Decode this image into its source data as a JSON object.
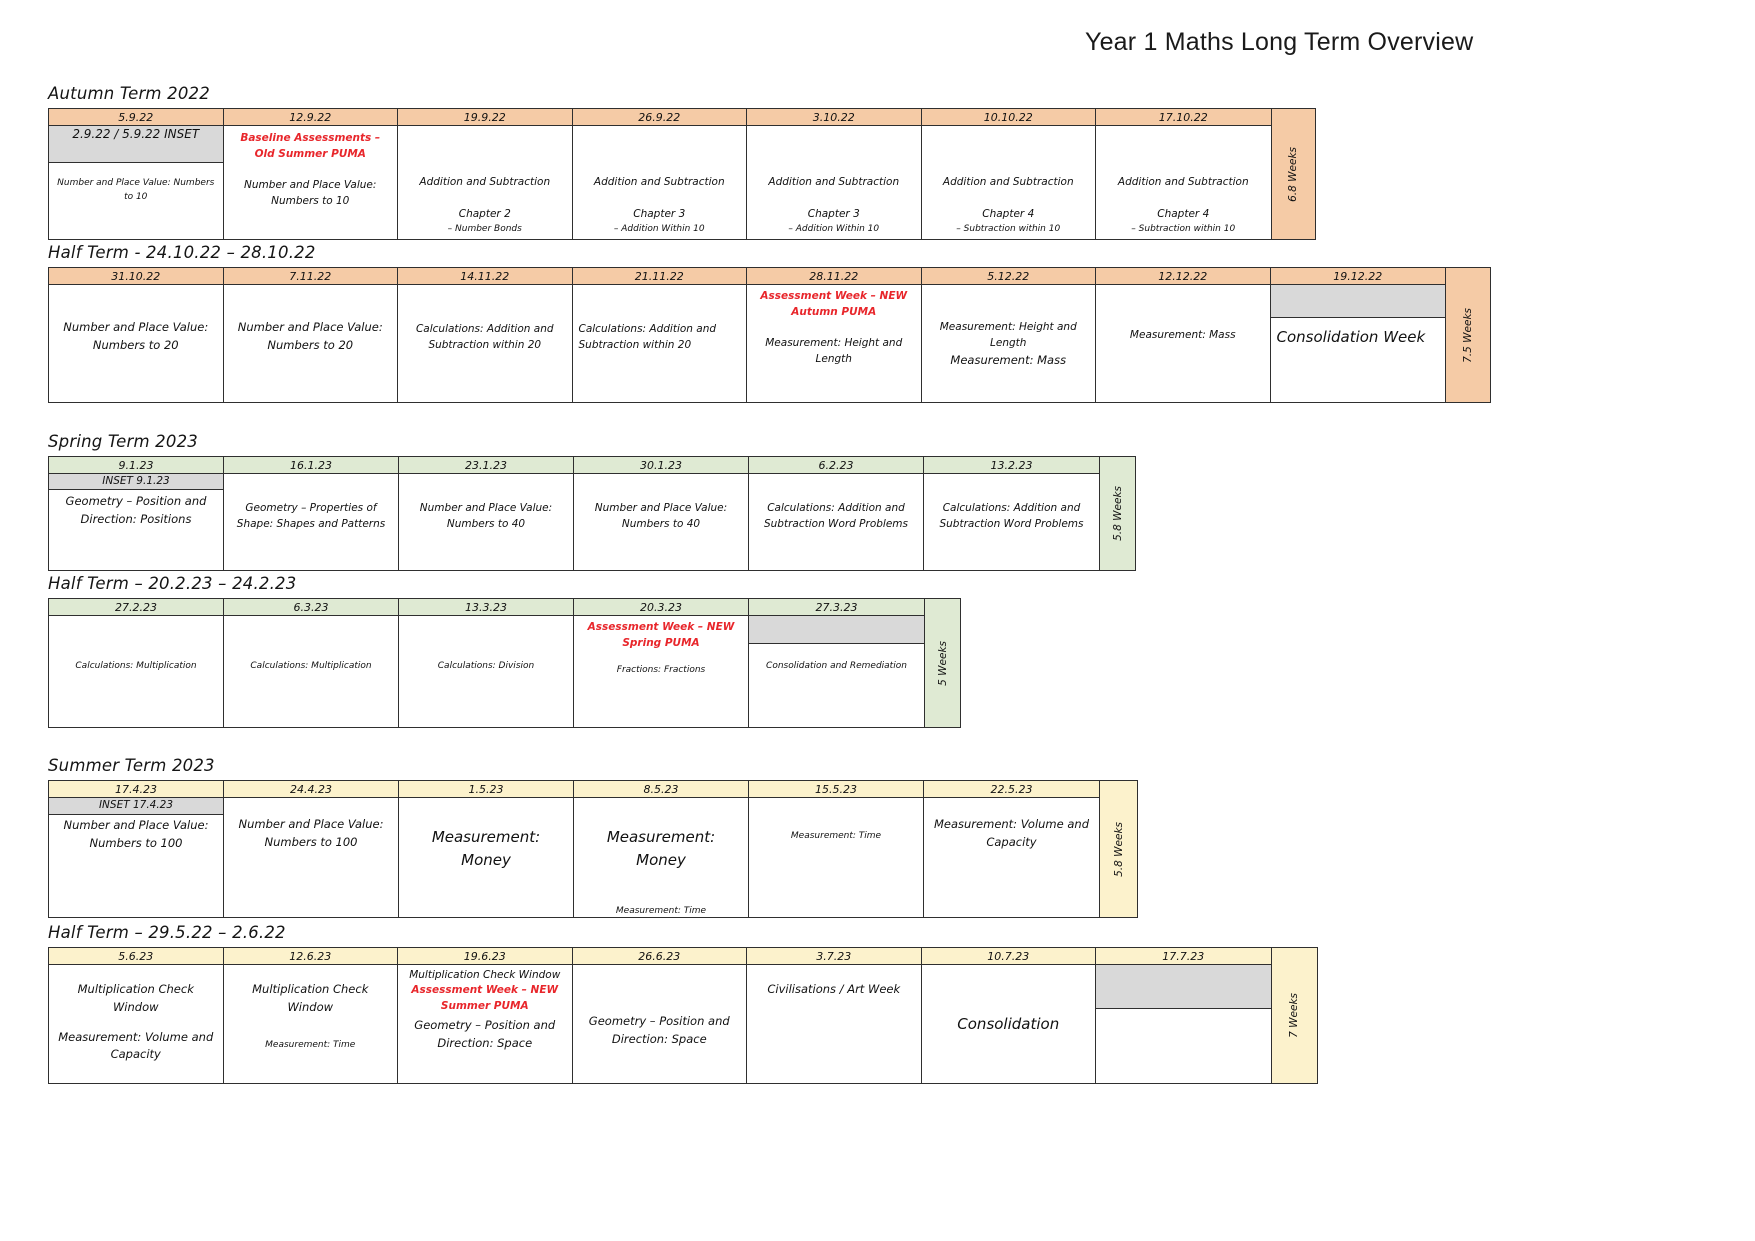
{
  "title": "Year 1 Maths Long Term Overview",
  "colors": {
    "autumn_header": "#F5CBA6",
    "spring_header": "#DFEAD3",
    "summer_header": "#FCF2CC",
    "inset_grey": "#D9D9D9",
    "assessment_red": "#E8262B",
    "border": "#2F2F2F"
  },
  "sections": [
    {
      "heading": "Autumn Term 2022",
      "theme": "autumn",
      "weeks": "6.8 Weeks",
      "layout": {
        "margin_top": 0,
        "col_width": 174.5,
        "body_height": 113,
        "weeks_width": 44
      },
      "cols": [
        {
          "date": "5.9.22",
          "blocks": [
            {
              "style": "inset",
              "text": "2.9.22 / 5.9.22 INSET",
              "h": 37,
              "fs": 12
            },
            {
              "style": "xs",
              "text": "Number and Place Value: Numbers to 10",
              "mt": 14
            }
          ]
        },
        {
          "date": "12.9.22",
          "blocks": [
            {
              "style": "red",
              "text": "Baseline Assessments – Old Summer PUMA",
              "mt": 5
            },
            {
              "style": "sm",
              "text": "Number and Place Value: Numbers to 10",
              "mt": 14
            }
          ]
        },
        {
          "date": "19.9.22",
          "blocks": [
            {
              "style": "sm",
              "text": "Addition and Subtraction",
              "mt": 48
            },
            {
              "style": "sm",
              "text": "Chapter 2",
              "mt": 16
            },
            {
              "style": "xs",
              "text": "– Number Bonds",
              "mt": 0
            }
          ]
        },
        {
          "date": "26.9.22",
          "blocks": [
            {
              "style": "sm",
              "text": "Addition and Subtraction",
              "mt": 48
            },
            {
              "style": "sm",
              "text": "Chapter 3",
              "mt": 16
            },
            {
              "style": "xs",
              "text": "– Addition Within 10",
              "mt": 0
            }
          ]
        },
        {
          "date": "3.10.22",
          "blocks": [
            {
              "style": "sm",
              "text": "Addition and Subtraction",
              "mt": 48
            },
            {
              "style": "sm",
              "text": "Chapter 3",
              "mt": 16
            },
            {
              "style": "xs",
              "text": "– Addition Within 10",
              "mt": 0
            }
          ]
        },
        {
          "date": "10.10.22",
          "blocks": [
            {
              "style": "sm",
              "text": "Addition and Subtraction",
              "mt": 48
            },
            {
              "style": "sm",
              "text": "Chapter 4",
              "mt": 16
            },
            {
              "style": "xs",
              "text": "– Subtraction within 10",
              "mt": 0
            }
          ]
        },
        {
          "date": "17.10.22",
          "blocks": [
            {
              "style": "sm",
              "text": "Addition and Subtraction",
              "mt": 48
            },
            {
              "style": "sm",
              "text": "Chapter 4",
              "mt": 16
            },
            {
              "style": "xs",
              "text": "– Subtraction within 10",
              "mt": 0
            }
          ]
        }
      ]
    },
    {
      "heading": "Half Term  - 24.10.22 – 28.10.22",
      "theme": "autumn",
      "weeks": "7.5 Weeks",
      "layout": {
        "margin_top": 3,
        "col_width": 174.5,
        "body_height": 117,
        "weeks_width": 45
      },
      "cols": [
        {
          "date": "31.10.22",
          "blocks": [
            {
              "style": "md",
              "text": "Number and Place Value: Numbers to 20",
              "mt": 34
            }
          ]
        },
        {
          "date": "7.11.22",
          "blocks": [
            {
              "style": "md",
              "text": "Number and Place Value: Numbers to 20",
              "mt": 34
            }
          ]
        },
        {
          "date": "14.11.22",
          "blocks": [
            {
              "style": "sm",
              "text": "Calculations: Addition and Subtraction within 20",
              "mt": 36
            }
          ]
        },
        {
          "date": "21.11.22",
          "blocks": [
            {
              "style": "sm",
              "text": "Calculations: Addition and Subtraction within 20",
              "mt": 36,
              "align": "left"
            }
          ]
        },
        {
          "date": "28.11.22",
          "blocks": [
            {
              "style": "red",
              "text": "Assessment Week – NEW Autumn PUMA",
              "mt": 4
            },
            {
              "style": "sm",
              "text": "Measurement: Height and Length",
              "mt": 14
            }
          ]
        },
        {
          "date": "5.12.22",
          "blocks": [
            {
              "style": "sm",
              "text": "Measurement: Height and Length",
              "mt": 34
            },
            {
              "style": "md",
              "text": "Measurement: Mass",
              "mt": 0
            }
          ]
        },
        {
          "date": "12.12.22",
          "blocks": [
            {
              "style": "sm",
              "text": "Measurement: Mass",
              "mt": 42
            }
          ]
        },
        {
          "date": "19.12.22",
          "blocks": [
            {
              "style": "grey",
              "h": 33
            },
            {
              "style": "lg",
              "text": "Consolidation Week",
              "mt": 8,
              "align": "left"
            }
          ]
        }
      ]
    },
    {
      "heading": "Spring Term 2023",
      "theme": "spring",
      "weeks": "5.8 Weeks",
      "layout": {
        "margin_top": 29,
        "col_width": 175,
        "body_height": 96,
        "weeks_width": 36
      },
      "cols": [
        {
          "date": "9.1.23",
          "blocks": [
            {
              "style": "inset",
              "text": "INSET 9.1.23",
              "h": 16
            },
            {
              "style": "md",
              "text": "Geometry – Position and Direction: Positions",
              "mt": 3
            }
          ]
        },
        {
          "date": "16.1.23",
          "blocks": [
            {
              "style": "sm",
              "text": "Geometry – Properties of Shape: Shapes and Patterns",
              "mt": 26
            }
          ]
        },
        {
          "date": "23.1.23",
          "blocks": [
            {
              "style": "sm",
              "text": "Number and Place Value: Numbers to 40",
              "mt": 26
            }
          ]
        },
        {
          "date": "30.1.23",
          "blocks": [
            {
              "style": "sm",
              "text": "Number and Place Value: Numbers to 40",
              "mt": 26
            }
          ]
        },
        {
          "date": "6.2.23",
          "blocks": [
            {
              "style": "sm",
              "text": "Calculations: Addition and Subtraction Word Problems",
              "mt": 26
            }
          ]
        },
        {
          "date": "13.2.23",
          "blocks": [
            {
              "style": "sm",
              "text": "Calculations: Addition and Subtraction Word Problems",
              "mt": 26
            }
          ]
        }
      ]
    },
    {
      "heading": "Half Term – 20.2.23 – 24.2.23",
      "theme": "spring",
      "weeks": "5 Weeks",
      "layout": {
        "margin_top": 3,
        "col_width": 175,
        "body_height": 111,
        "weeks_width": 36
      },
      "cols": [
        {
          "date": "27.2.23",
          "blocks": [
            {
              "style": "xs",
              "text": "Calculations: Multiplication",
              "mt": 44
            }
          ]
        },
        {
          "date": "6.3.23",
          "blocks": [
            {
              "style": "xs",
              "text": "Calculations: Multiplication",
              "mt": 44
            }
          ]
        },
        {
          "date": "13.3.23",
          "blocks": [
            {
              "style": "xs",
              "text": "Calculations: Division",
              "mt": 44
            }
          ]
        },
        {
          "date": "20.3.23",
          "blocks": [
            {
              "style": "red",
              "text": "Assessment Week – NEW Spring PUMA",
              "mt": 4
            },
            {
              "style": "xs",
              "text": "Fractions: Fractions",
              "mt": 12
            }
          ]
        },
        {
          "date": "27.3.23",
          "blocks": [
            {
              "style": "grey",
              "h": 28
            },
            {
              "style": "xs",
              "text": "Consolidation and Remediation",
              "mt": 16
            }
          ]
        }
      ]
    },
    {
      "heading": "Summer Term 2023",
      "theme": "summer",
      "weeks": "5.8 Weeks",
      "layout": {
        "margin_top": 28,
        "col_width": 175,
        "body_height": 119,
        "weeks_width": 38
      },
      "cols": [
        {
          "date": "17.4.23",
          "blocks": [
            {
              "style": "inset",
              "text": "INSET 17.4.23",
              "h": 17
            },
            {
              "style": "md",
              "text": "Number and Place Value: Numbers to 100",
              "mt": 2
            }
          ]
        },
        {
          "date": "24.4.23",
          "blocks": [
            {
              "style": "md",
              "text": "Number and Place Value: Numbers to 100",
              "mt": 18
            }
          ]
        },
        {
          "date": "1.5.23",
          "blocks": [
            {
              "style": "lg",
              "text": "Measurement: Money",
              "mt": 28
            }
          ]
        },
        {
          "date": "8.5.23",
          "blocks": [
            {
              "style": "lg",
              "text": "Measurement: Money",
              "mt": 28
            },
            {
              "style": "xs",
              "text": "Measurement: Time",
              "mt": 32
            }
          ]
        },
        {
          "date": "15.5.23",
          "blocks": [
            {
              "style": "xs",
              "text": "Measurement: Time",
              "mt": 32
            }
          ]
        },
        {
          "date": "22.5.23",
          "blocks": [
            {
              "style": "md",
              "text": "Measurement: Volume and Capacity",
              "mt": 18
            }
          ]
        }
      ]
    },
    {
      "heading": "Half Term – 29.5.22 – 2.6.22",
      "theme": "summer",
      "weeks": "7 Weeks",
      "layout": {
        "margin_top": 5,
        "col_width": 174.5,
        "body_height": 118,
        "weeks_width": 46
      },
      "cols": [
        {
          "date": "5.6.23",
          "blocks": [
            {
              "style": "md",
              "text": "Multiplication Check Window",
              "mt": 16
            },
            {
              "style": "md",
              "text": "Measurement: Volume and Capacity",
              "mt": 12
            }
          ]
        },
        {
          "date": "12.6.23",
          "blocks": [
            {
              "style": "md",
              "text": "Multiplication Check Window",
              "mt": 16
            },
            {
              "style": "xs",
              "text": "Measurement: Time",
              "mt": 22
            }
          ]
        },
        {
          "date": "19.6.23",
          "blocks": [
            {
              "style": "sm",
              "text": "Multiplication Check Window",
              "mt": 2
            },
            {
              "style": "red",
              "text": "Assessment Week – NEW Summer PUMA",
              "mt": 0
            },
            {
              "style": "md",
              "text": "Geometry – Position and Direction: Space",
              "mt": 2
            }
          ]
        },
        {
          "date": "26.6.23",
          "blocks": [
            {
              "style": "md",
              "text": "Geometry – Position and Direction: Space",
              "mt": 48
            }
          ]
        },
        {
          "date": "3.7.23",
          "blocks": [
            {
              "style": "md",
              "text": "Civilisations / Art Week",
              "mt": 16
            }
          ]
        },
        {
          "date": "10.7.23",
          "blocks": [
            {
              "style": "lg",
              "text": "Consolidation",
              "mt": 48
            }
          ]
        },
        {
          "date": "17.7.23",
          "blocks": [
            {
              "style": "grey",
              "h": 44
            }
          ]
        }
      ]
    }
  ]
}
